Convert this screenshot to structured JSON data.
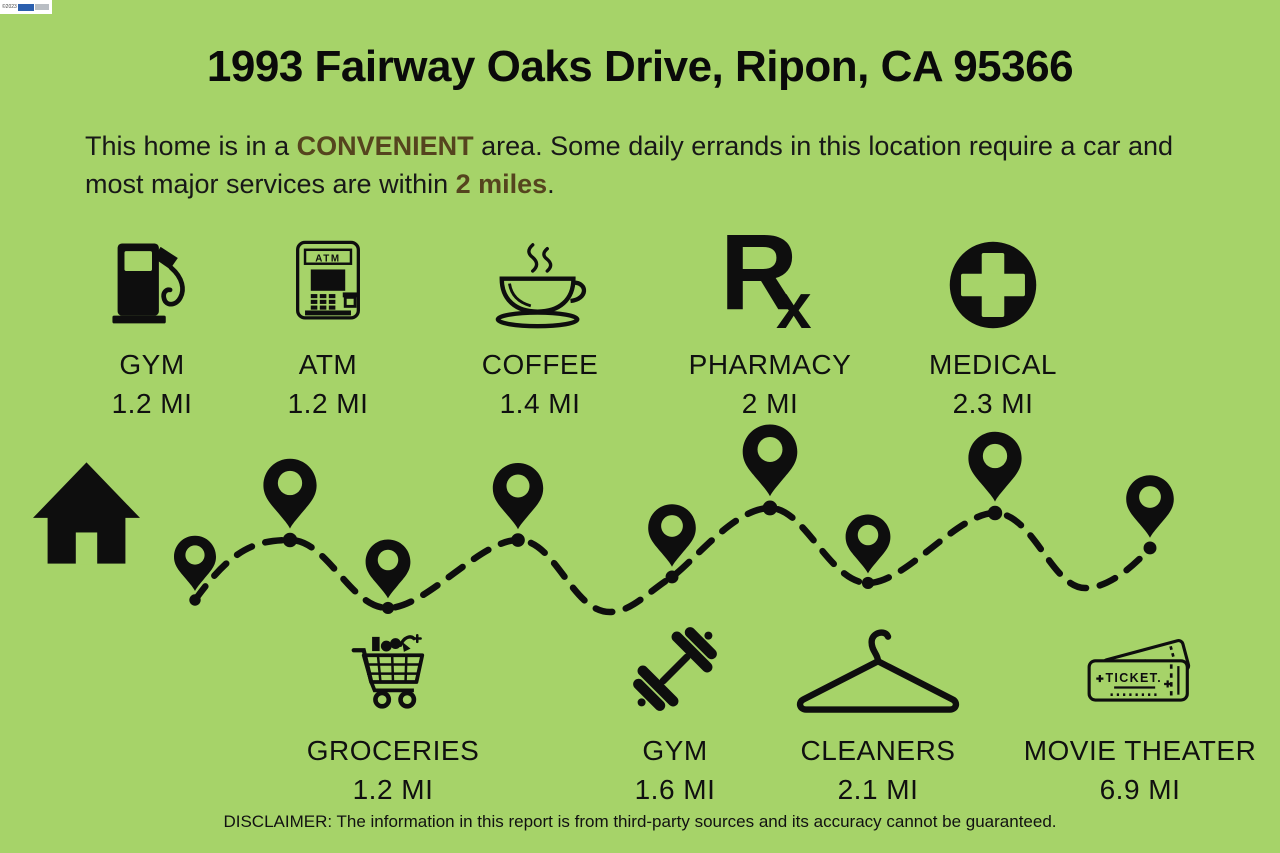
{
  "watermark": {
    "copyright": "©2023"
  },
  "title": "1993 Fairway Oaks Drive, Ripon, CA 95366",
  "summary": {
    "part1": "This home is in a ",
    "highlight1": "CONVENIENT",
    "part2": " area. Some daily errands in this location require a car and most major services are within ",
    "highlight2": "2 miles",
    "part3": "."
  },
  "top_amenities": [
    {
      "name": "GYM",
      "distance": "1.2 MI",
      "icon": "gas-pump-icon"
    },
    {
      "name": "ATM",
      "distance": "1.2 MI",
      "icon": "atm-icon"
    },
    {
      "name": "COFFEE",
      "distance": "1.4 MI",
      "icon": "coffee-cup-icon"
    },
    {
      "name": "PHARMACY",
      "distance": "2 MI",
      "icon": "rx-icon"
    },
    {
      "name": "MEDICAL",
      "distance": "2.3 MI",
      "icon": "medical-cross-icon"
    }
  ],
  "bottom_amenities": [
    {
      "name": "GROCERIES",
      "distance": "1.2 MI",
      "icon": "grocery-cart-icon"
    },
    {
      "name": "GYM",
      "distance": "1.6 MI",
      "icon": "dumbbell-icon"
    },
    {
      "name": "CLEANERS",
      "distance": "2.1 MI",
      "icon": "hanger-icon"
    },
    {
      "name": "MOVIE THEATER",
      "distance": "6.9 MI",
      "icon": "movie-tickets-icon"
    }
  ],
  "icon_labels": {
    "atm": "ATM",
    "rx_r": "R",
    "rx_x": "x",
    "ticket": "TICKET."
  },
  "disclaimer": "DISCLAIMER: The information in this report is from third-party sources and its accuracy cannot be guaranteed.",
  "colors": {
    "background": "#a6d369",
    "ink": "#0e0e0e",
    "accent_brown": "#55441e"
  }
}
